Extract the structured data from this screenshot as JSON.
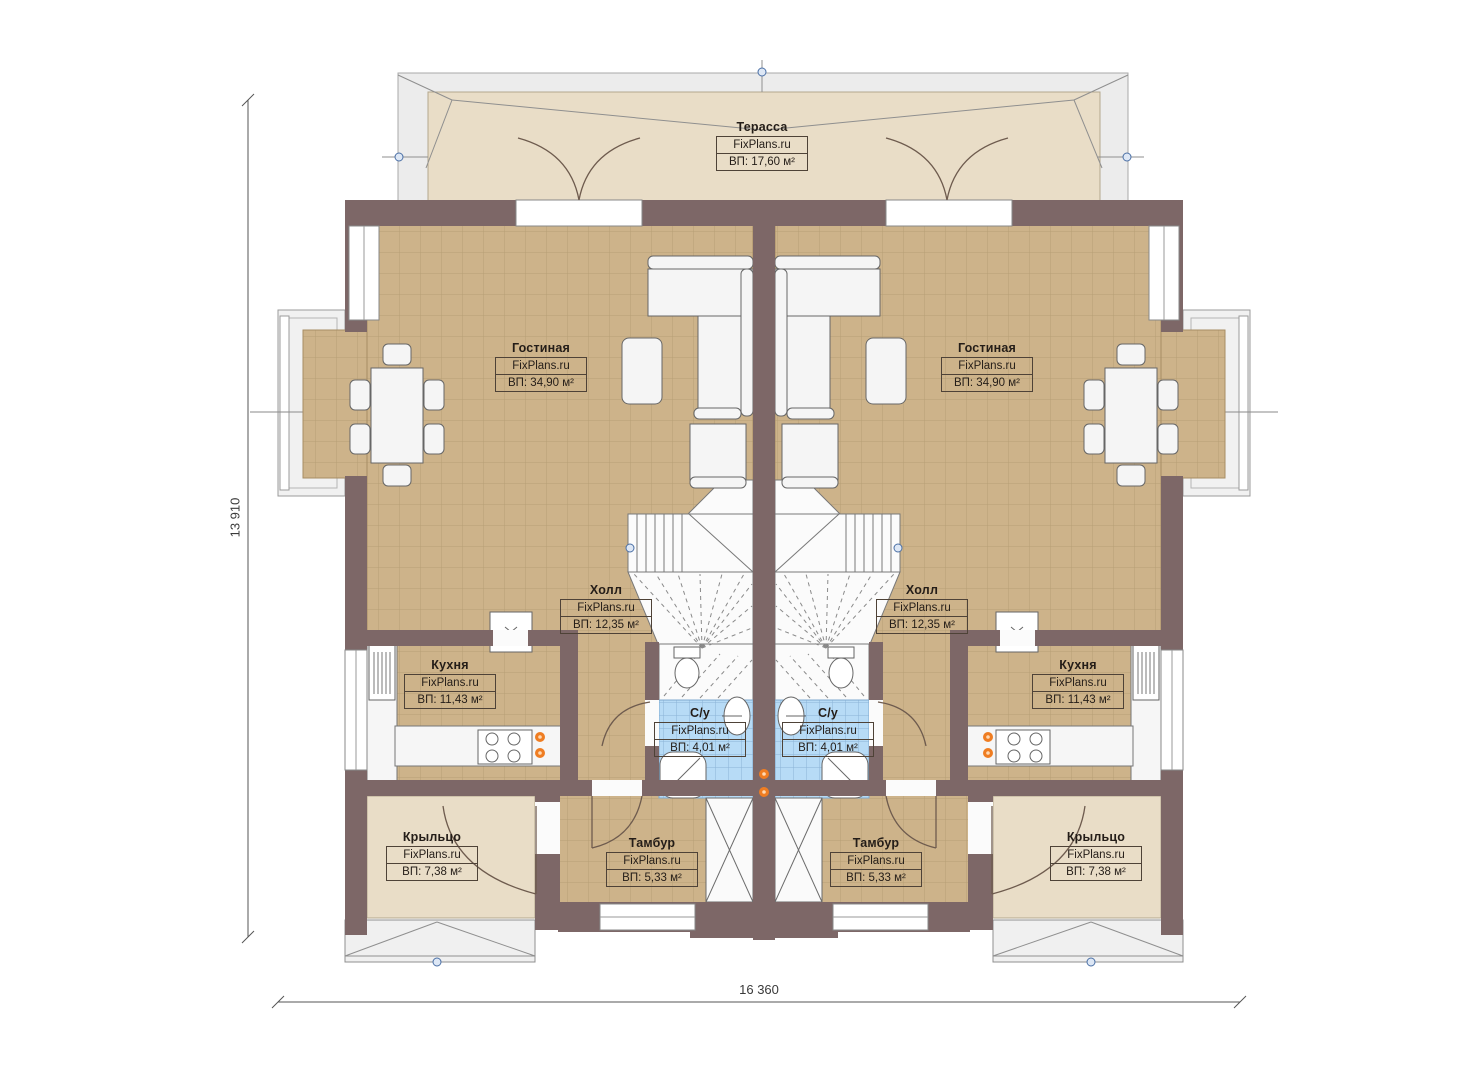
{
  "brand": "FixPlans.ru",
  "dimensions": {
    "width_label": "16 360",
    "height_label": "13 910"
  },
  "rooms": {
    "terrace": {
      "name": "Терасса",
      "area": "ВП: 17,60 м²"
    },
    "living_left": {
      "name": "Гостиная",
      "area": "ВП: 34,90 м²"
    },
    "living_right": {
      "name": "Гостиная",
      "area": "ВП: 34,90 м²"
    },
    "hall_left": {
      "name": "Холл",
      "area": "ВП: 12,35 м²"
    },
    "hall_right": {
      "name": "Холл",
      "area": "ВП: 12,35 м²"
    },
    "kitchen_left": {
      "name": "Кухня",
      "area": "ВП: 11,43 м²"
    },
    "kitchen_right": {
      "name": "Кухня",
      "area": "ВП: 11,43 м²"
    },
    "wc_left": {
      "name": "С/у",
      "area": "ВП: 4,01 м²"
    },
    "wc_right": {
      "name": "С/у",
      "area": "ВП: 4,01 м²"
    },
    "tambour_left": {
      "name": "Тамбур",
      "area": "ВП: 5,33 м²"
    },
    "tambour_right": {
      "name": "Тамбур",
      "area": "ВП: 5,33 м²"
    },
    "porch_left": {
      "name": "Крыльцо",
      "area": "ВП: 7,38 м²"
    },
    "porch_right": {
      "name": "Крыльцо",
      "area": "ВП: 7,38 м²"
    }
  },
  "colors": {
    "wall": "#7d6767",
    "floor_tile": "#cdb38a",
    "bath_tile": "#b7dbf6",
    "terrace_floor": "#e9ddc7",
    "socket_marker": "#ef7d22",
    "axis_marker": "#4a6fa5"
  }
}
